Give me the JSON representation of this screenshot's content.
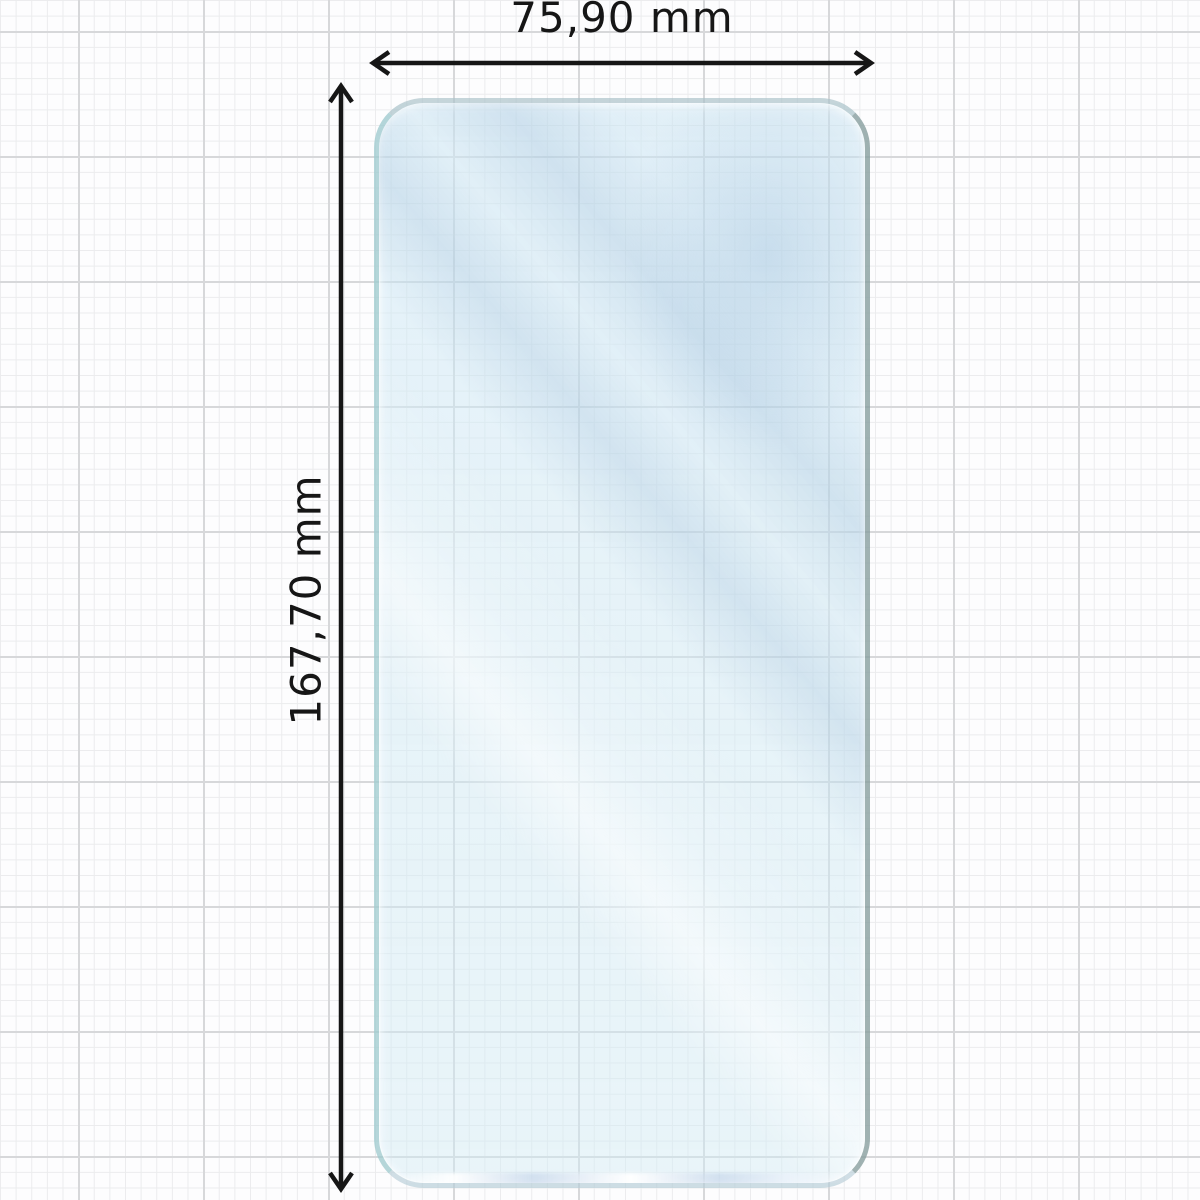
{
  "diagram": {
    "type": "screen-protector-dimension-diagram",
    "width_label": "75,90 mm",
    "height_label": "167,70 mm"
  },
  "colors": {
    "background": "#fdfdfe",
    "grid_minor": "#ebeced",
    "grid_major": "#d7d8da",
    "film_tint": "#d5e9f3",
    "film_edge_left": "#8bbfc0",
    "film_edge_right": "#708683",
    "dimension_line": "#161616",
    "label_text": "#161616"
  }
}
